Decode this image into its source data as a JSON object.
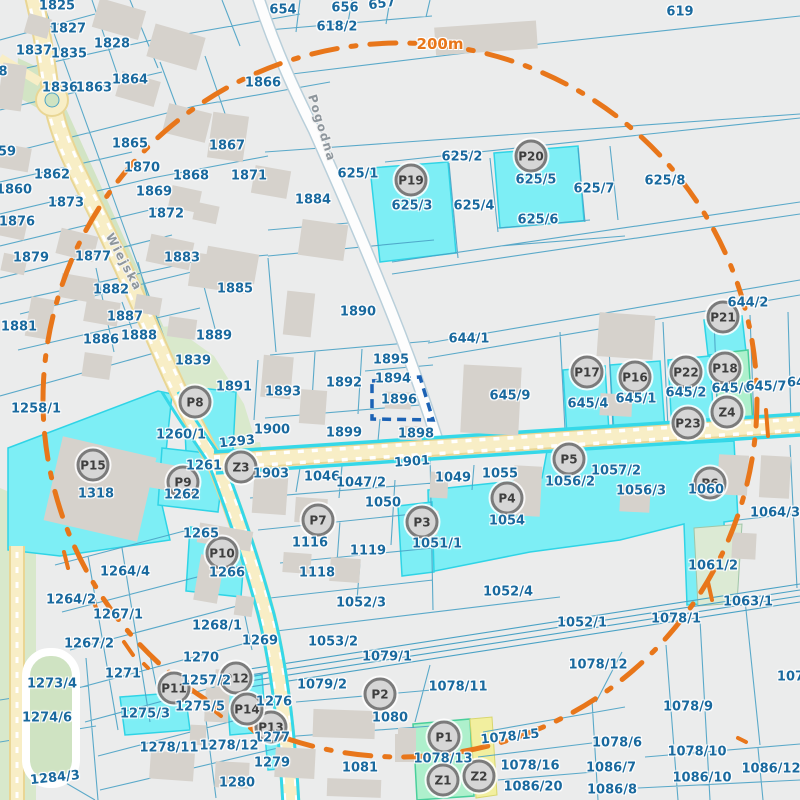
{
  "map": {
    "scale_label": "200m",
    "selected_parcel": "1896",
    "colors": {
      "background": "#ebecec",
      "parcel_line": "#4aa2c5",
      "parcel_label": "#19699e",
      "highlight_fill": "#7deef5",
      "highlight_border": "#2fd4e6",
      "green_parcel_fill": "#aef0cc",
      "pale_green_parcel": "#dcead4",
      "yellow_strip_parcel": "#f2ef9f",
      "road_fill": "#f8eec6",
      "road_edge": "#e9d694",
      "building": "#d6d2cc",
      "marker_fill": "#d6d6d6",
      "marker_border": "#7b7b7b",
      "selection_outline": "#1b62b5",
      "range_ring": "#e8761a",
      "green_area": "#d2e4c4"
    },
    "streets": [
      {
        "name": "Wiejska",
        "x": 124,
        "y": 262,
        "r": 62
      },
      {
        "name": "Pogodna",
        "x": 322,
        "y": 128,
        "r": 73
      }
    ],
    "scale_pos": {
      "x": 440,
      "y": 44
    },
    "markers": [
      {
        "id": "P1",
        "x": 444,
        "y": 737
      },
      {
        "id": "P2",
        "x": 380,
        "y": 694
      },
      {
        "id": "P3",
        "x": 422,
        "y": 522
      },
      {
        "id": "P4",
        "x": 507,
        "y": 498
      },
      {
        "id": "P5",
        "x": 569,
        "y": 459
      },
      {
        "id": "P6",
        "x": 710,
        "y": 483
      },
      {
        "id": "P7",
        "x": 318,
        "y": 520
      },
      {
        "id": "P8",
        "x": 195,
        "y": 402
      },
      {
        "id": "P9",
        "x": 183,
        "y": 482
      },
      {
        "id": "P10",
        "x": 222,
        "y": 553
      },
      {
        "id": "P11",
        "x": 174,
        "y": 688
      },
      {
        "id": "P12",
        "x": 236,
        "y": 678
      },
      {
        "id": "P13",
        "x": 271,
        "y": 727
      },
      {
        "id": "P14",
        "x": 247,
        "y": 709
      },
      {
        "id": "P15",
        "x": 93,
        "y": 465
      },
      {
        "id": "P16",
        "x": 635,
        "y": 377
      },
      {
        "id": "P17",
        "x": 587,
        "y": 372
      },
      {
        "id": "P18",
        "x": 725,
        "y": 368
      },
      {
        "id": "P19",
        "x": 411,
        "y": 180
      },
      {
        "id": "P20",
        "x": 531,
        "y": 156
      },
      {
        "id": "P21",
        "x": 723,
        "y": 317
      },
      {
        "id": "P22",
        "x": 686,
        "y": 372
      },
      {
        "id": "P23",
        "x": 688,
        "y": 423
      },
      {
        "id": "Z1",
        "x": 443,
        "y": 780
      },
      {
        "id": "Z2",
        "x": 479,
        "y": 776
      },
      {
        "id": "Z3",
        "x": 241,
        "y": 467
      },
      {
        "id": "Z4",
        "x": 727,
        "y": 412
      }
    ],
    "parcel_labels": [
      {
        "t": "654",
        "x": 283,
        "y": 10
      },
      {
        "t": "656",
        "x": 345,
        "y": 8
      },
      {
        "t": "657",
        "x": 382,
        "y": 4,
        "r": -8
      },
      {
        "t": "618/2",
        "x": 337,
        "y": 27
      },
      {
        "t": "619",
        "x": 680,
        "y": 12
      },
      {
        "t": "1825",
        "x": 57,
        "y": 6
      },
      {
        "t": "1827",
        "x": 68,
        "y": 29
      },
      {
        "t": "1828",
        "x": 112,
        "y": 44
      },
      {
        "t": "1837",
        "x": 34,
        "y": 51
      },
      {
        "t": "1835",
        "x": 69,
        "y": 54
      },
      {
        "t": "1836",
        "x": 60,
        "y": 88
      },
      {
        "t": "1863",
        "x": 94,
        "y": 88
      },
      {
        "t": "1864",
        "x": 130,
        "y": 80
      },
      {
        "t": "1866",
        "x": 263,
        "y": 83
      },
      {
        "t": "1865",
        "x": 130,
        "y": 144
      },
      {
        "t": "1867",
        "x": 227,
        "y": 146
      },
      {
        "t": "1870",
        "x": 142,
        "y": 168
      },
      {
        "t": "1868",
        "x": 191,
        "y": 176
      },
      {
        "t": "1871",
        "x": 249,
        "y": 176
      },
      {
        "t": "1869",
        "x": 154,
        "y": 192
      },
      {
        "t": "1872",
        "x": 166,
        "y": 214
      },
      {
        "t": "1862",
        "x": 52,
        "y": 175
      },
      {
        "t": "1860",
        "x": 14,
        "y": 190
      },
      {
        "t": "1873",
        "x": 66,
        "y": 203
      },
      {
        "t": "1876",
        "x": 17,
        "y": 222
      },
      {
        "t": "1879",
        "x": 31,
        "y": 258
      },
      {
        "t": "1877",
        "x": 93,
        "y": 257
      },
      {
        "t": "1883",
        "x": 182,
        "y": 258
      },
      {
        "t": "8",
        "x": 3,
        "y": 72
      },
      {
        "t": "59",
        "x": 7,
        "y": 152
      },
      {
        "t": "1881",
        "x": 19,
        "y": 327
      },
      {
        "t": "1882",
        "x": 111,
        "y": 290
      },
      {
        "t": "1887",
        "x": 125,
        "y": 317
      },
      {
        "t": "1886",
        "x": 101,
        "y": 340
      },
      {
        "t": "1888",
        "x": 139,
        "y": 336
      },
      {
        "t": "1885",
        "x": 235,
        "y": 289
      },
      {
        "t": "1889",
        "x": 214,
        "y": 336
      },
      {
        "t": "1839",
        "x": 193,
        "y": 361
      },
      {
        "t": "1891",
        "x": 234,
        "y": 387
      },
      {
        "t": "1884",
        "x": 313,
        "y": 200
      },
      {
        "t": "625/1",
        "x": 358,
        "y": 174
      },
      {
        "t": "625/2",
        "x": 462,
        "y": 157
      },
      {
        "t": "625/3",
        "x": 412,
        "y": 206
      },
      {
        "t": "625/4",
        "x": 474,
        "y": 206
      },
      {
        "t": "625/5",
        "x": 536,
        "y": 180
      },
      {
        "t": "625/6",
        "x": 538,
        "y": 220
      },
      {
        "t": "625/7",
        "x": 594,
        "y": 189
      },
      {
        "t": "625/8",
        "x": 665,
        "y": 181
      },
      {
        "t": "1890",
        "x": 358,
        "y": 312
      },
      {
        "t": "644/1",
        "x": 469,
        "y": 339
      },
      {
        "t": "644/2",
        "x": 748,
        "y": 303
      },
      {
        "t": "1895",
        "x": 391,
        "y": 360
      },
      {
        "t": "1894",
        "x": 393,
        "y": 379
      },
      {
        "t": "1896",
        "x": 399,
        "y": 400
      },
      {
        "t": "1892",
        "x": 344,
        "y": 383
      },
      {
        "t": "1893",
        "x": 283,
        "y": 392
      },
      {
        "t": "645/9",
        "x": 510,
        "y": 396
      },
      {
        "t": "645/4",
        "x": 588,
        "y": 404
      },
      {
        "t": "645/1",
        "x": 636,
        "y": 399
      },
      {
        "t": "645/2",
        "x": 686,
        "y": 393
      },
      {
        "t": "645/6",
        "x": 732,
        "y": 389
      },
      {
        "t": "645/7",
        "x": 766,
        "y": 387
      },
      {
        "t": "64",
        "x": 796,
        "y": 383
      },
      {
        "t": "1900",
        "x": 272,
        "y": 430
      },
      {
        "t": "1293",
        "x": 237,
        "y": 442,
        "r": -6
      },
      {
        "t": "1899",
        "x": 344,
        "y": 433
      },
      {
        "t": "1898",
        "x": 416,
        "y": 434
      },
      {
        "t": "1901",
        "x": 412,
        "y": 462,
        "r": -4
      },
      {
        "t": "1903",
        "x": 271,
        "y": 474
      },
      {
        "t": "1046",
        "x": 322,
        "y": 477
      },
      {
        "t": "1047/2",
        "x": 361,
        "y": 483
      },
      {
        "t": "1049",
        "x": 453,
        "y": 478
      },
      {
        "t": "1055",
        "x": 500,
        "y": 474
      },
      {
        "t": "1057/2",
        "x": 616,
        "y": 471
      },
      {
        "t": "1056/2",
        "x": 570,
        "y": 482
      },
      {
        "t": "1056/3",
        "x": 641,
        "y": 491
      },
      {
        "t": "1060",
        "x": 706,
        "y": 490
      },
      {
        "t": "1064/3",
        "x": 775,
        "y": 513
      },
      {
        "t": "1258/1",
        "x": 36,
        "y": 409
      },
      {
        "t": "1260/1",
        "x": 181,
        "y": 435
      },
      {
        "t": "1261",
        "x": 204,
        "y": 466
      },
      {
        "t": "1262",
        "x": 182,
        "y": 495
      },
      {
        "t": "1318",
        "x": 96,
        "y": 494
      },
      {
        "t": "1265",
        "x": 201,
        "y": 534
      },
      {
        "t": "1266",
        "x": 227,
        "y": 573
      },
      {
        "t": "1264/4",
        "x": 125,
        "y": 572
      },
      {
        "t": "1264/2",
        "x": 71,
        "y": 600
      },
      {
        "t": "1267/1",
        "x": 118,
        "y": 615
      },
      {
        "t": "1267/2",
        "x": 89,
        "y": 644
      },
      {
        "t": "1268/1",
        "x": 217,
        "y": 626
      },
      {
        "t": "1269",
        "x": 260,
        "y": 641
      },
      {
        "t": "1270",
        "x": 201,
        "y": 658
      },
      {
        "t": "1271",
        "x": 123,
        "y": 674
      },
      {
        "t": "1273/4",
        "x": 52,
        "y": 684
      },
      {
        "t": "1274/6",
        "x": 47,
        "y": 718
      },
      {
        "t": "1257/2",
        "x": 206,
        "y": 681
      },
      {
        "t": "1275/5",
        "x": 200,
        "y": 707
      },
      {
        "t": "1275/3",
        "x": 145,
        "y": 714
      },
      {
        "t": "1276",
        "x": 274,
        "y": 702
      },
      {
        "t": "1277",
        "x": 272,
        "y": 738
      },
      {
        "t": "1279",
        "x": 272,
        "y": 763
      },
      {
        "t": "1278/11",
        "x": 169,
        "y": 748
      },
      {
        "t": "1278/12",
        "x": 229,
        "y": 746
      },
      {
        "t": "1280",
        "x": 237,
        "y": 783
      },
      {
        "t": "1284/3",
        "x": 55,
        "y": 778,
        "r": -6
      },
      {
        "t": "1054",
        "x": 507,
        "y": 521
      },
      {
        "t": "1050",
        "x": 383,
        "y": 503
      },
      {
        "t": "1051/1",
        "x": 437,
        "y": 544
      },
      {
        "t": "1116",
        "x": 310,
        "y": 543
      },
      {
        "t": "1119",
        "x": 368,
        "y": 551
      },
      {
        "t": "1118",
        "x": 317,
        "y": 573
      },
      {
        "t": "1052/3",
        "x": 361,
        "y": 603
      },
      {
        "t": "1052/4",
        "x": 508,
        "y": 592
      },
      {
        "t": "1053/2",
        "x": 333,
        "y": 642
      },
      {
        "t": "1079/1",
        "x": 387,
        "y": 657
      },
      {
        "t": "1079/2",
        "x": 322,
        "y": 685
      },
      {
        "t": "1078/11",
        "x": 458,
        "y": 687
      },
      {
        "t": "1080",
        "x": 390,
        "y": 718
      },
      {
        "t": "1081",
        "x": 360,
        "y": 768
      },
      {
        "t": "1078/13",
        "x": 443,
        "y": 759
      },
      {
        "t": "1078/15",
        "x": 510,
        "y": 737,
        "r": -6
      },
      {
        "t": "1078/16",
        "x": 530,
        "y": 766
      },
      {
        "t": "1086/20",
        "x": 533,
        "y": 787
      },
      {
        "t": "1078/6",
        "x": 617,
        "y": 743
      },
      {
        "t": "1086/7",
        "x": 611,
        "y": 768
      },
      {
        "t": "1086/8",
        "x": 612,
        "y": 790
      },
      {
        "t": "1078/10",
        "x": 697,
        "y": 752
      },
      {
        "t": "1086/10",
        "x": 702,
        "y": 778
      },
      {
        "t": "1086/12",
        "x": 771,
        "y": 769
      },
      {
        "t": "1078/12",
        "x": 598,
        "y": 665
      },
      {
        "t": "1078/9",
        "x": 688,
        "y": 707
      },
      {
        "t": "1052/1",
        "x": 582,
        "y": 623
      },
      {
        "t": "1078/1",
        "x": 676,
        "y": 619
      },
      {
        "t": "1063/1",
        "x": 748,
        "y": 602
      },
      {
        "t": "1061/2",
        "x": 713,
        "y": 566
      },
      {
        "t": "1077",
        "x": 795,
        "y": 677
      }
    ]
  }
}
